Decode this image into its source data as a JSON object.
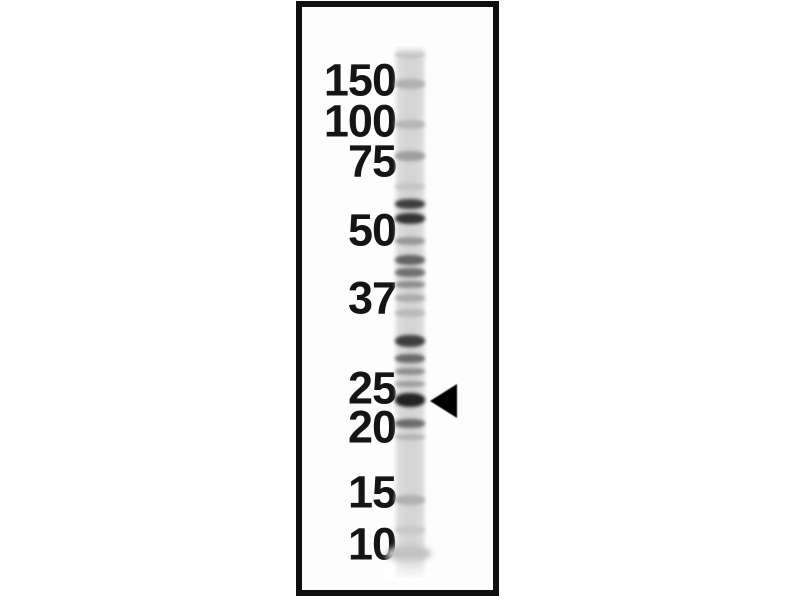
{
  "figure": {
    "kind": "western-blot-single-lane",
    "background_color": "#ffffff",
    "panel": {
      "border_color": "#101010",
      "fill_color": "#fdfdfd"
    },
    "marker_labels": [
      {
        "text": "150",
        "y": 80
      },
      {
        "text": "100",
        "y": 121
      },
      {
        "text": "75",
        "y": 161
      },
      {
        "text": "50",
        "y": 230
      },
      {
        "text": "37",
        "y": 298
      },
      {
        "text": "25",
        "y": 388
      },
      {
        "text": "20",
        "y": 427
      },
      {
        "text": "15",
        "y": 492
      },
      {
        "text": "10",
        "y": 544
      }
    ],
    "lane": {
      "left": 393,
      "top": 46,
      "width": 34,
      "height": 532,
      "base_color": "#d4d4d4"
    },
    "bands": [
      {
        "y": 54,
        "h": 8,
        "color": "#c2c2c2"
      },
      {
        "y": 84,
        "h": 10,
        "color": "#b0b0b0"
      },
      {
        "y": 124,
        "h": 9,
        "color": "#b6b6b6"
      },
      {
        "y": 156,
        "h": 10,
        "color": "#9e9e9e"
      },
      {
        "y": 186,
        "h": 7,
        "color": "#c4c4c4"
      },
      {
        "y": 204,
        "h": 10,
        "color": "#3e3e3e"
      },
      {
        "y": 218,
        "h": 11,
        "color": "#343434"
      },
      {
        "y": 241,
        "h": 8,
        "color": "#999999"
      },
      {
        "y": 260,
        "h": 10,
        "color": "#636363"
      },
      {
        "y": 272,
        "h": 9,
        "color": "#6f6f6f"
      },
      {
        "y": 284,
        "h": 7,
        "color": "#8c8c8c"
      },
      {
        "y": 298,
        "h": 8,
        "color": "#ababab"
      },
      {
        "y": 313,
        "h": 8,
        "color": "#bababa"
      },
      {
        "y": 341,
        "h": 12,
        "color": "#3f3f3f"
      },
      {
        "y": 358,
        "h": 9,
        "color": "#6a6a6a"
      },
      {
        "y": 371,
        "h": 7,
        "color": "#8e8e8e"
      },
      {
        "y": 384,
        "h": 6,
        "color": "#9c9c9c"
      },
      {
        "y": 400,
        "h": 14,
        "color": "#232323"
      },
      {
        "y": 423,
        "h": 9,
        "color": "#6b6b6b"
      },
      {
        "y": 437,
        "h": 6,
        "color": "#b4b4b4"
      },
      {
        "y": 500,
        "h": 10,
        "color": "#b0b0b0"
      },
      {
        "y": 530,
        "h": 8,
        "color": "#c8c8c8"
      },
      {
        "y": 554,
        "h": 16,
        "color": "#c2c2c2",
        "wide": true
      }
    ],
    "arrow": {
      "tip_x": 430,
      "y": 401,
      "depth": 27,
      "half_height": 17,
      "color": "#000000"
    }
  }
}
